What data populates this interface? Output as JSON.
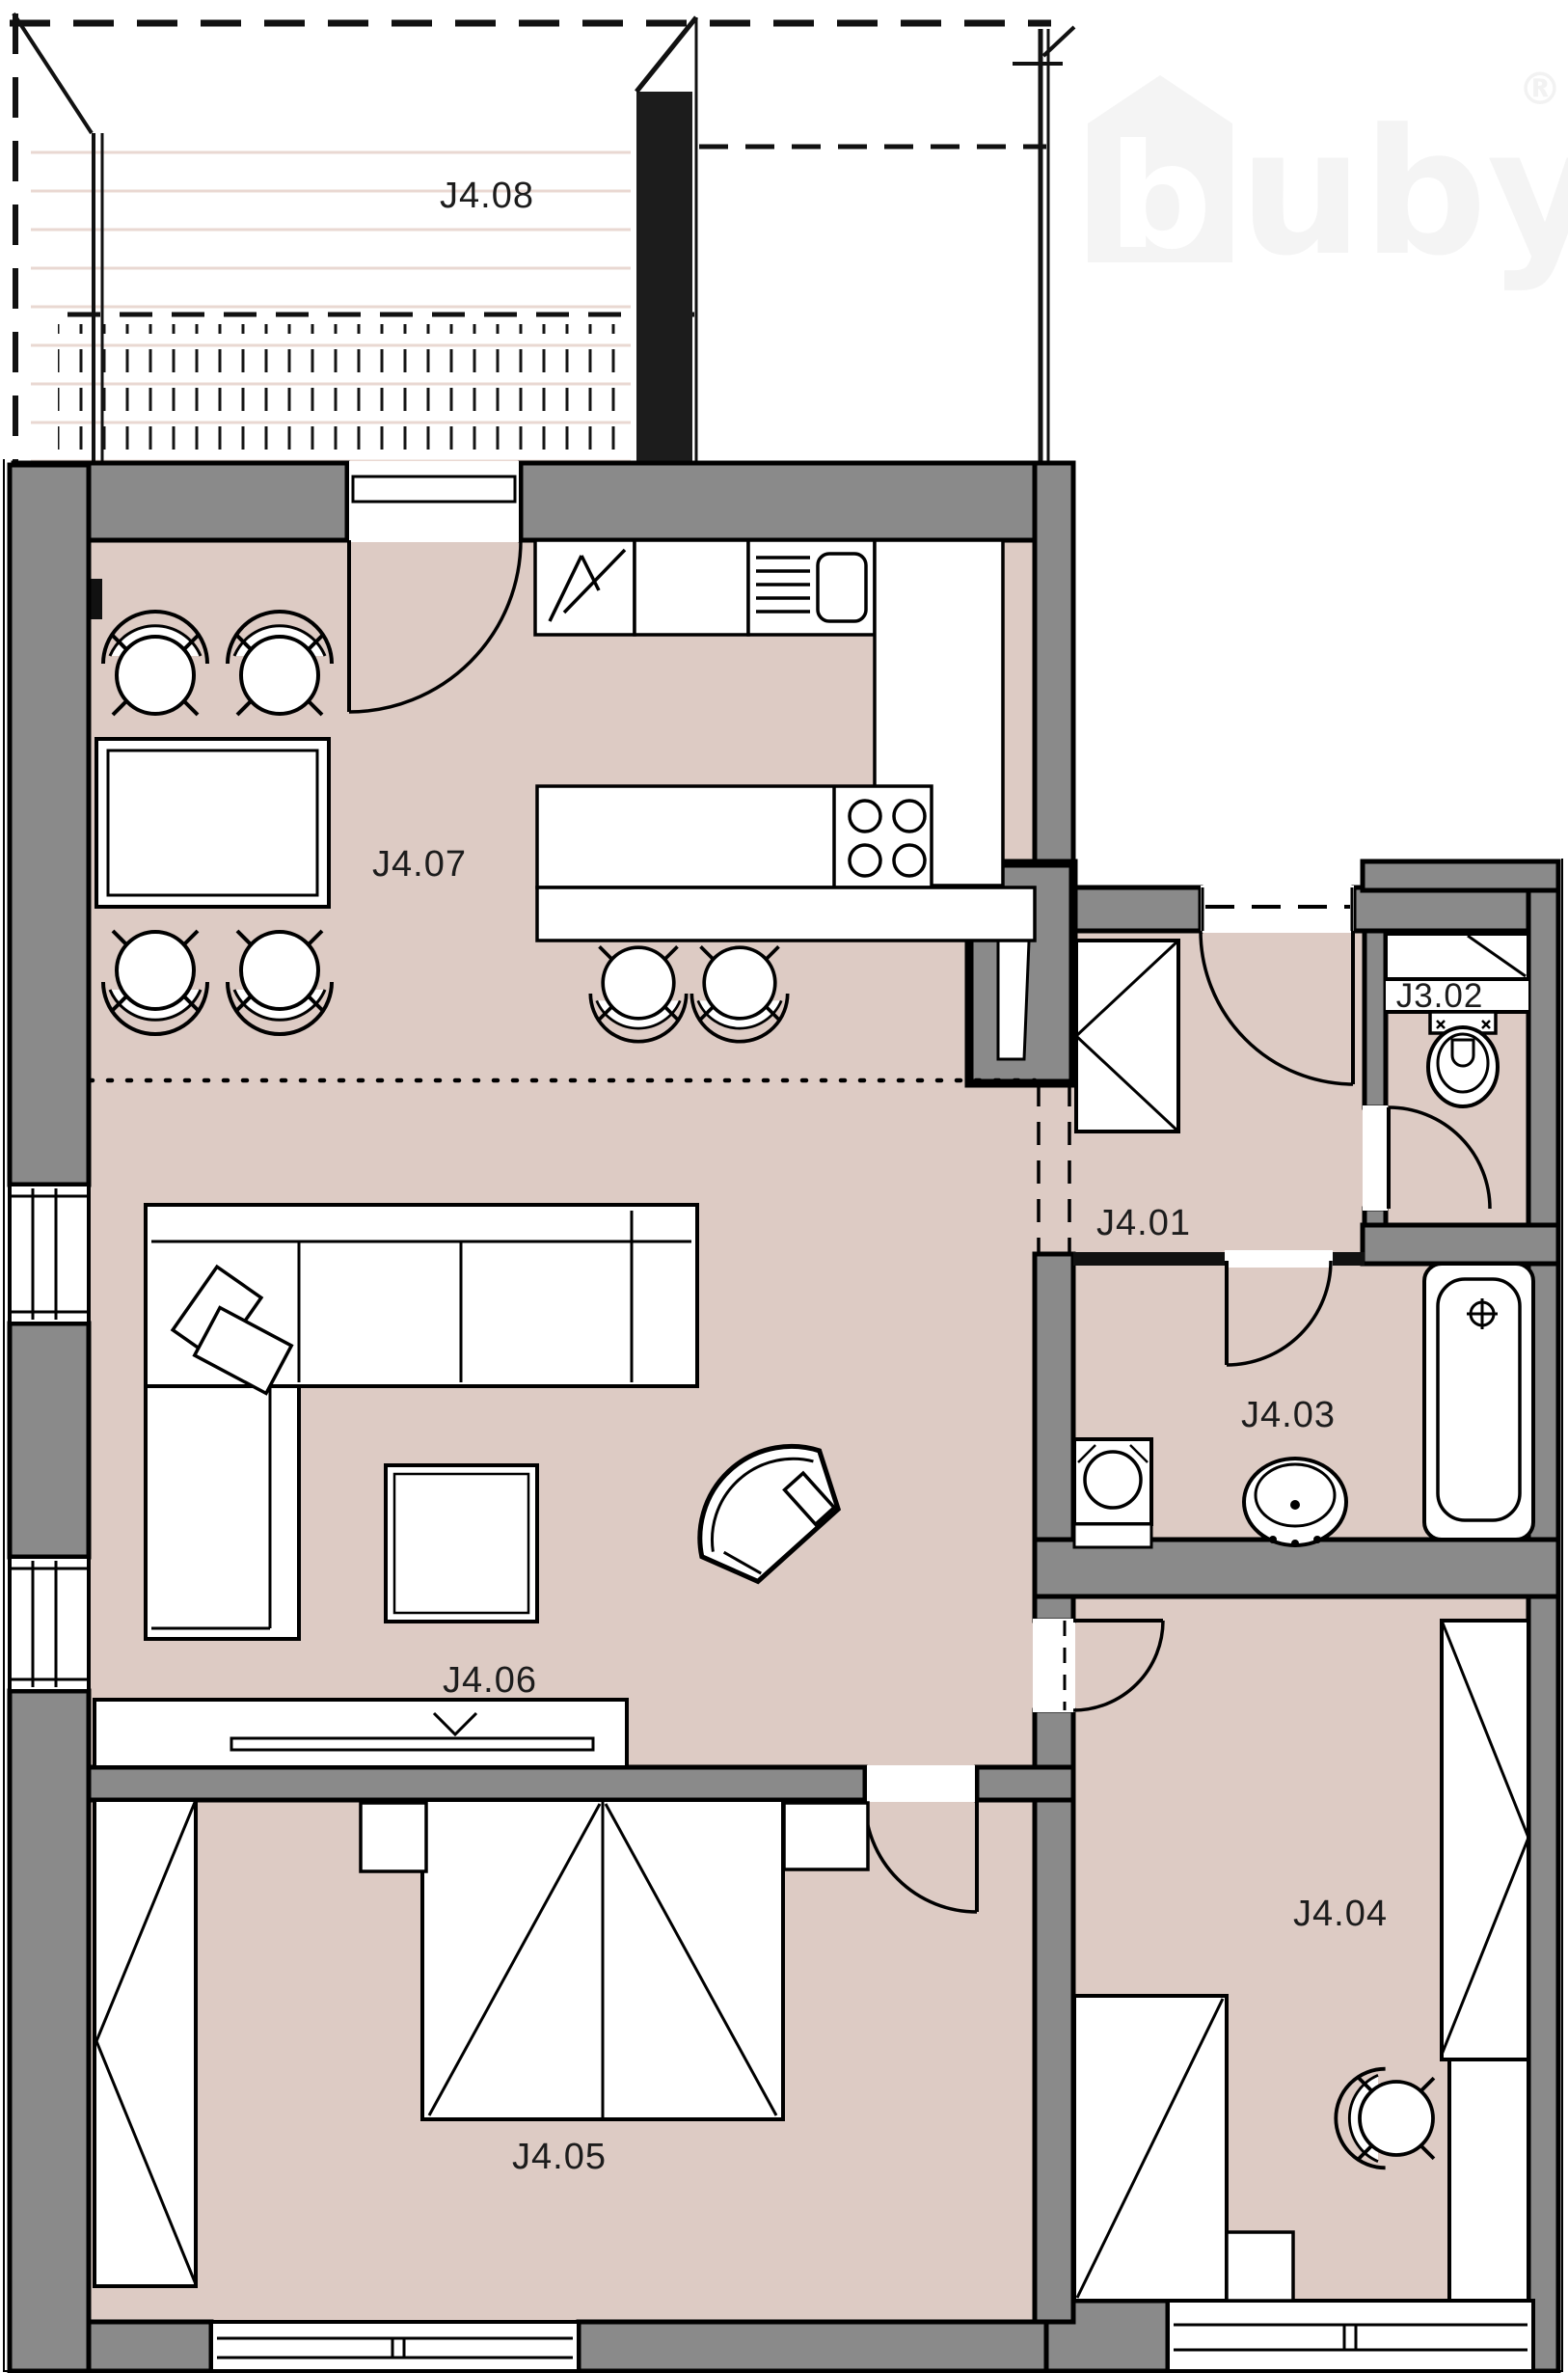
{
  "watermark": {
    "logo_letter": "b",
    "brand_text": "uby",
    "registered_mark": "®",
    "color": "#f4f4f4"
  },
  "rooms": {
    "j408": {
      "label": "J4.08",
      "type": "terrace"
    },
    "j407": {
      "label": "J4.07",
      "type": "kitchen-dining"
    },
    "j401": {
      "label": "J4.01",
      "type": "entrance-hall"
    },
    "j302": {
      "label": "J3.02",
      "type": "toilet"
    },
    "j403": {
      "label": "J4.03",
      "type": "bathroom"
    },
    "j406": {
      "label": "J4.06",
      "type": "living-room"
    },
    "j405": {
      "label": "J4.05",
      "type": "bedroom"
    },
    "j404": {
      "label": "J4.04",
      "type": "bedroom"
    }
  },
  "colors": {
    "floor": "#ddcbc4",
    "wall": "#8a8a8a",
    "outline": "#000000",
    "deck_line": "#e9d8d2",
    "background": "#ffffff"
  },
  "furniture": {
    "j407": [
      "dining-table",
      "dining-chair-x4",
      "kitchen-cabinet-row",
      "dishwasher",
      "kitchen-sink",
      "l-counter",
      "kitchen-island",
      "cooktop-4-burner",
      "bar-counter",
      "bar-stool-x2",
      "terrace-door"
    ],
    "j406": [
      "corner-sofa",
      "cushion-x2",
      "coffee-table",
      "armchair",
      "tv-sideboard",
      "tv"
    ],
    "j401": [
      "wardrobe",
      "entrance-door",
      "installation-shaft"
    ],
    "j302": [
      "shelf-niche",
      "toilet",
      "door"
    ],
    "j403": [
      "washing-machine",
      "washbasin",
      "bathtub",
      "door"
    ],
    "j405": [
      "double-bed",
      "nightstand-x2",
      "wardrobe",
      "window",
      "door"
    ],
    "j404": [
      "single-bed",
      "nightstand",
      "desk",
      "desk-chair",
      "wardrobe",
      "window",
      "door"
    ]
  }
}
